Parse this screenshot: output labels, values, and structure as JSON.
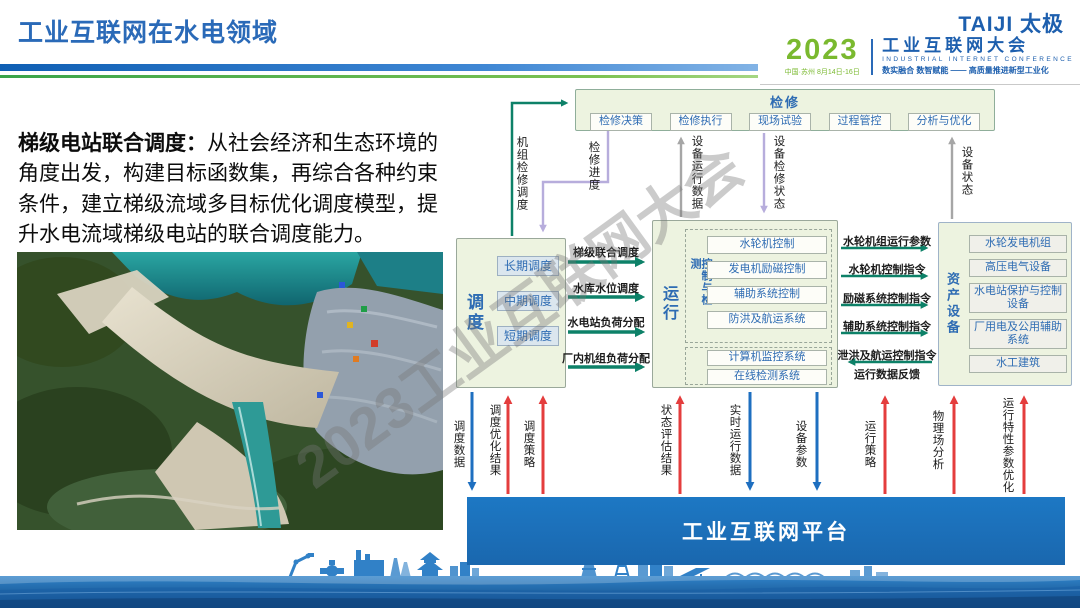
{
  "header": {
    "title": "工业互联网在水电领域",
    "taiji_logo": "TAIJI 太极",
    "conference": {
      "year": "2023",
      "venue": "中国·苏州  8月14日-16日",
      "name": "工业互联网大会",
      "name_en": "INDUSTRIAL INTERNET CONFERENCE",
      "slogan": "数实融合  数智赋能 —— 高质量推进新型工业化"
    }
  },
  "intro": {
    "lead": "梯级电站联合调度：",
    "body": "从社会经济和生态环境的角度出发，构建目标函数集，再综合各种约束条件，建立梯级流域多目标优化调度模型，提升水电流域梯级电站的联合调度能力。"
  },
  "watermark": "2023工业互联网大会",
  "diagram": {
    "maintenance": {
      "title": "检修",
      "items": [
        "检修决策",
        "检修执行",
        "现场试验",
        "过程管控",
        "分析与优化"
      ]
    },
    "dispatch": {
      "title": "调度",
      "items": [
        "长期调度",
        "中期调度",
        "短期调度"
      ]
    },
    "operation": {
      "title": "运行",
      "control": {
        "title": "控制与检测",
        "items": [
          "水轮机控制",
          "发电机励磁控制",
          "辅助系统控制",
          "防洪及航运系统"
        ]
      },
      "monitor": {
        "items": [
          "计算机监控系统",
          "在线检测系统"
        ]
      }
    },
    "assets": {
      "title": "资产设备",
      "items": [
        "水轮发电机组",
        "高压电气设备",
        "水电站保护与控制设备",
        "厂用电及公用辅助系统",
        "水工建筑"
      ]
    },
    "top_links": [
      {
        "label": "机组检修调度",
        "dir": "up"
      },
      {
        "label": "检修进度",
        "dir": "down"
      },
      {
        "label": "设备运行数据",
        "dir": "up"
      },
      {
        "label": "设备检修状态",
        "dir": "down"
      },
      {
        "label": "设备状态",
        "dir": "up"
      }
    ],
    "dispatch_to_operation": [
      "梯级联合调度",
      "水库水位调度",
      "水电站负荷分配",
      "厂内机组负荷分配"
    ],
    "operation_to_assets": [
      {
        "label": "水轮机组运行参数",
        "dir": "right"
      },
      {
        "label": "水轮机控制指令",
        "dir": "right"
      },
      {
        "label": "励磁系统控制指令",
        "dir": "right"
      },
      {
        "label": "辅助系统控制指令",
        "dir": "right"
      },
      {
        "label": "泄洪及航运控制指令",
        "dir": "left"
      }
    ],
    "feedback_label": "运行数据反馈",
    "platform_links": [
      {
        "label": "调度数据",
        "dir": "down",
        "color": "blue"
      },
      {
        "label": "调度优化结果",
        "dir": "up",
        "color": "red"
      },
      {
        "label": "调度策略",
        "dir": "up",
        "color": "red"
      },
      {
        "label": "状态评估结果",
        "dir": "up",
        "color": "red"
      },
      {
        "label": "实时运行数据",
        "dir": "down",
        "color": "blue"
      },
      {
        "label": "设备参数",
        "dir": "down",
        "color": "blue"
      },
      {
        "label": "运行策略",
        "dir": "up",
        "color": "red"
      },
      {
        "label": "物理场分析",
        "dir": "up",
        "color": "red"
      },
      {
        "label": "运行特性参数优化",
        "dir": "up",
        "color": "red"
      }
    ],
    "platform": {
      "label": "工业互联网平台"
    }
  },
  "colors": {
    "title_blue": "#2a6ab8",
    "logo_green": "#7ab92f",
    "box_bg": "#edf3e0",
    "item_text_blue": "#2e6cb3",
    "arrow_teal": "#0d8168",
    "arrow_purple": "#b7addc",
    "arrow_gray": "#a6a6a6",
    "arrow_blue": "#1e6fc0",
    "arrow_red": "#e43d3d",
    "platform_blue": "#1b72bd"
  }
}
